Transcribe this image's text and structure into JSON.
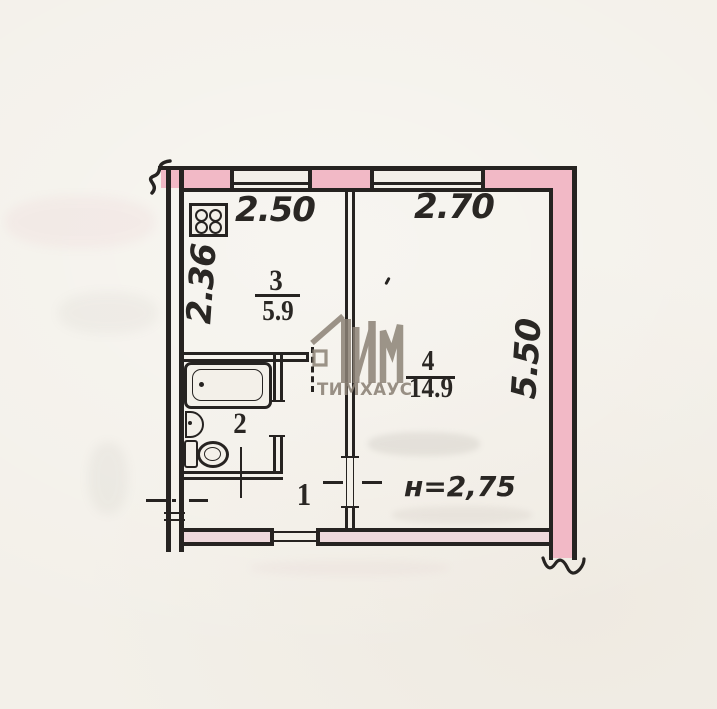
{
  "colors": {
    "paper": "#f3f0e9",
    "line": "#262321",
    "ink": "#2a2724",
    "wall_fill": "#f2b9c6",
    "wall_fill_light": "#eed9dc",
    "watermark": "#8c8276"
  },
  "dims": {
    "top_left": "2.50",
    "top_right": "2.70",
    "left": "2.36",
    "right": "5.50",
    "height": "н=2,75"
  },
  "rooms": {
    "kitchen": {
      "number": "3",
      "area": "5.9"
    },
    "living": {
      "number": "4",
      "area": "14.9"
    },
    "bath": {
      "number": "2"
    },
    "hall": {
      "number": "1"
    }
  },
  "watermark": {
    "text": "ТИМХАУС"
  },
  "icons": [
    "stove-icon",
    "bathtub-icon",
    "sink-icon",
    "toilet-icon"
  ]
}
